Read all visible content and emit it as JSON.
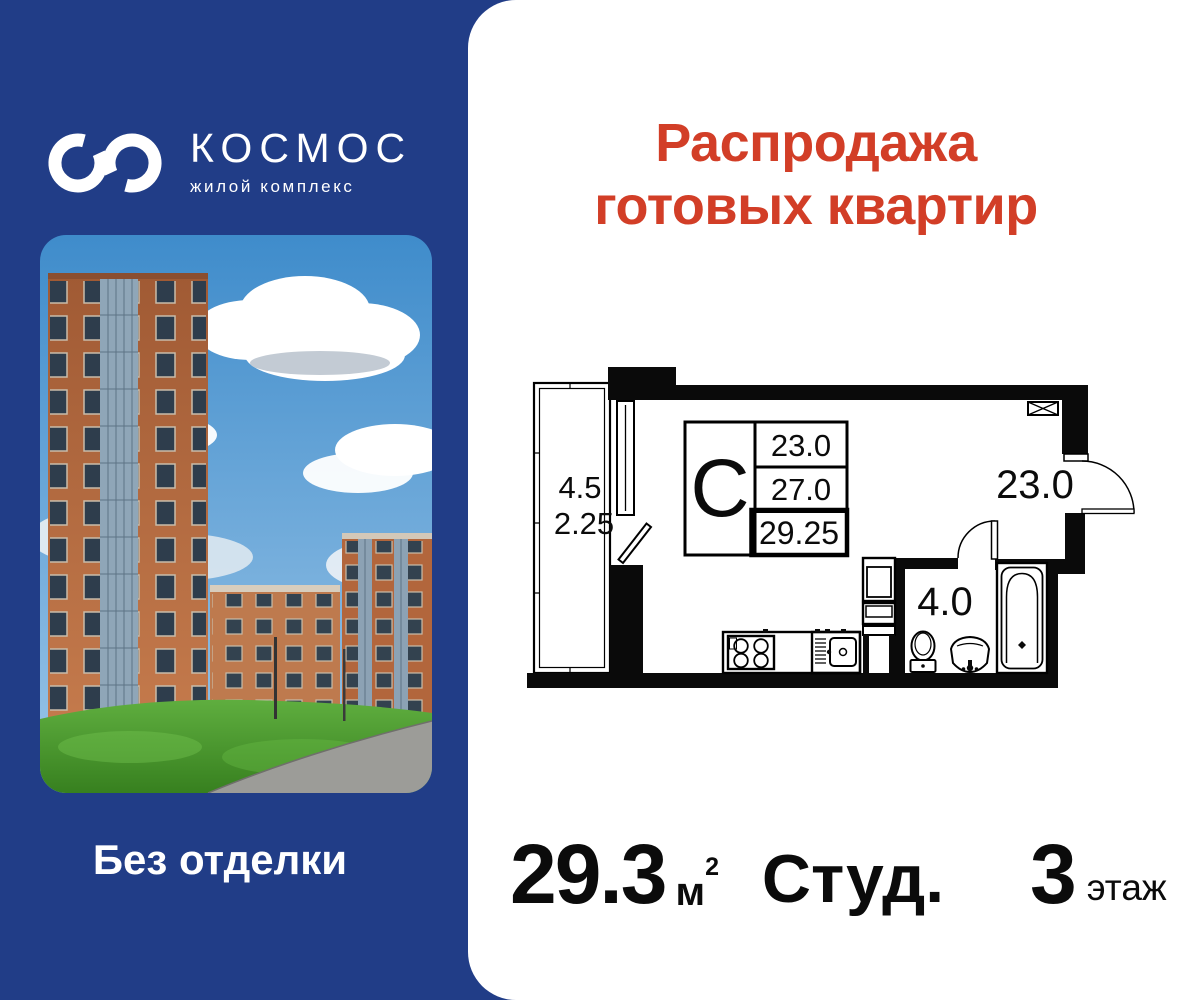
{
  "colors": {
    "panel_blue": "#213D87",
    "accent_red": "#D23E27"
  },
  "brand": {
    "name": "КОСМОС",
    "tagline": "жилой комплекс",
    "finish_label": "Без отделки"
  },
  "promo": {
    "title_line1": "Распродажа",
    "title_line2": "готовых квартир"
  },
  "floor_plan": {
    "balcony_area": "4.5",
    "balcony_area_reduced": "2.25",
    "type_letter": "С",
    "area_living": "23.0",
    "area_no_balcony": "27.0",
    "area_total": "29.25",
    "room_area": "23.0",
    "bathroom_area": "4.0"
  },
  "summary": {
    "area_value": "29.3",
    "area_unit": "м",
    "area_unit_sup": "2",
    "apartment_type": "Студ.",
    "floor_number": "3",
    "floor_label": "этаж"
  }
}
